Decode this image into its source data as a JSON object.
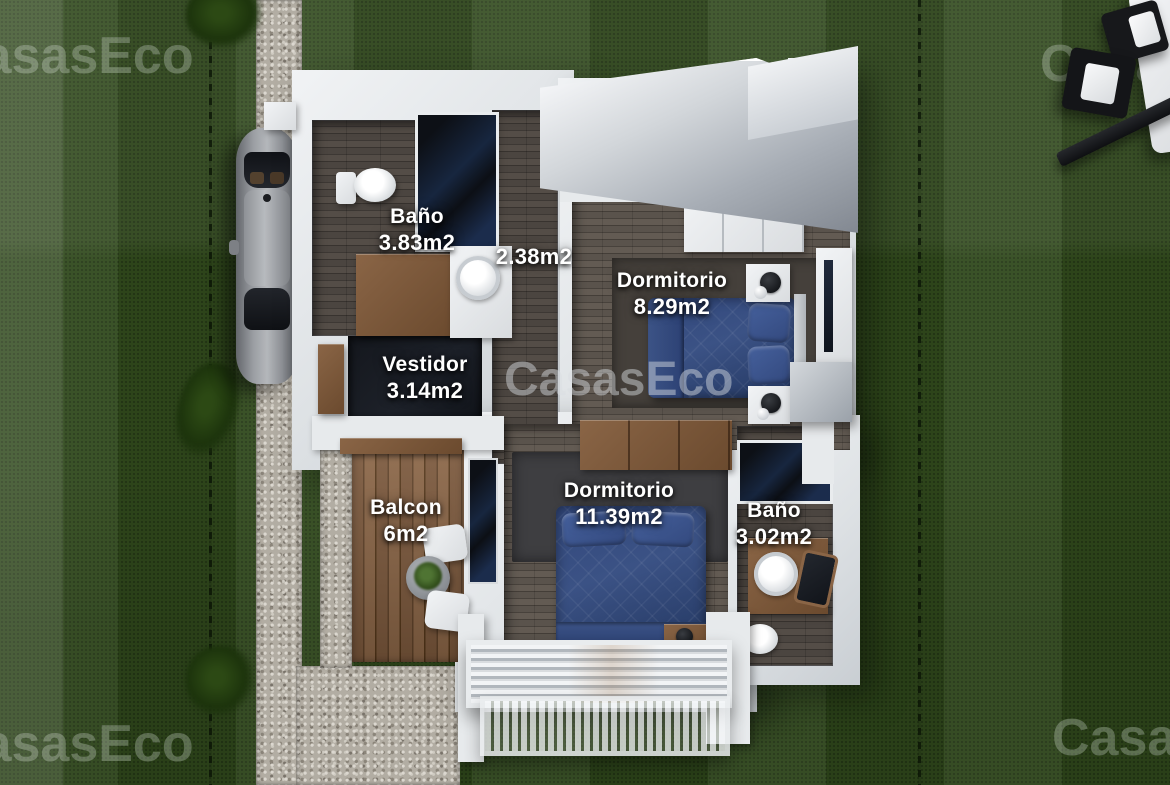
{
  "watermark": {
    "text": "CasasEco"
  },
  "labels": {
    "bathroom_top": {
      "name": "Baño",
      "area": "3.83m2"
    },
    "hallway": {
      "area": "2.38m2"
    },
    "bedroom_top": {
      "name": "Dormitorio",
      "area": "8.29m2"
    },
    "dressing_room": {
      "name": "Vestidor",
      "area": "3.14m2"
    },
    "balcony": {
      "name": "Balcon",
      "area": "6m2"
    },
    "bedroom_bottom": {
      "name": "Dormitorio",
      "area": "11.39m2"
    },
    "bathroom_bottom": {
      "name": "Baño",
      "area": "3.02m2"
    }
  },
  "colors": {
    "grass": "#30491c",
    "gravel": "#b2ada3",
    "walls": "#e7eaec",
    "roof_gray": "#aab1b8",
    "interior_floor": "#46413d",
    "deck_wood": "#7a583c",
    "bed_blue": "#30467a",
    "label_text": "#ffffff",
    "watermark_tint": "#d9dde0"
  }
}
